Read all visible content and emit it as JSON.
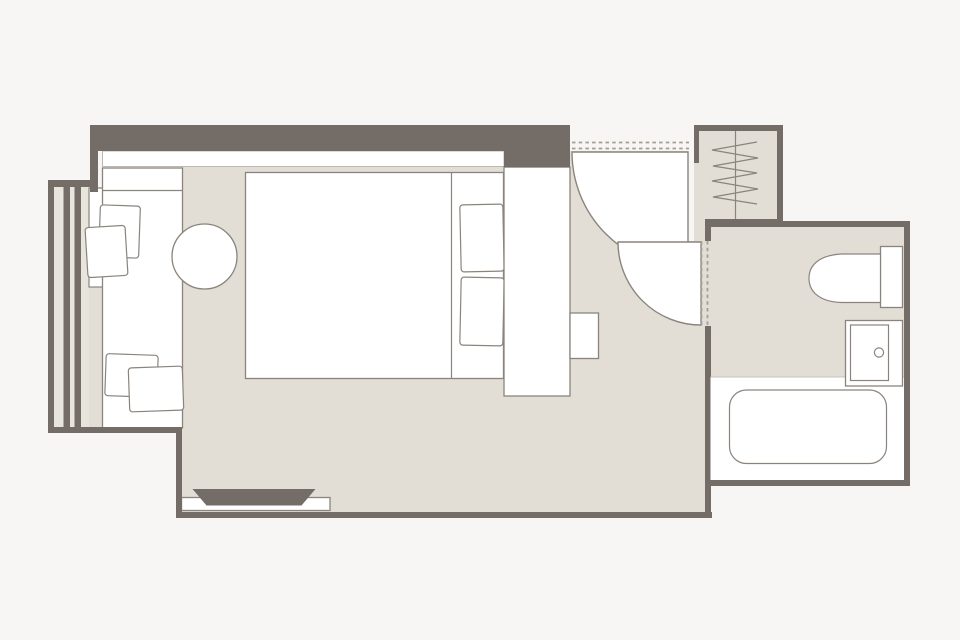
{
  "image": {
    "type": "hotel-room-floor-plan",
    "width_px": 960,
    "height_px": 640
  },
  "colors": {
    "bg": "#f7f6f5",
    "floor": "#e2ded5",
    "wall": "#746d67",
    "white": "#ffffff",
    "line": "#8a847d",
    "lightline": "#bcb7af",
    "dash": "#a49e95",
    "louver": "#e8e5dc"
  },
  "rooms": [
    "bedroom",
    "balcony-lounge",
    "entry",
    "closet",
    "bathroom"
  ],
  "fixtures": [
    "window-louvers",
    "lounge-daybed",
    "lounge-cushions",
    "coffee-table",
    "double-bed",
    "bed-pillows",
    "wardrobe",
    "nightstand",
    "tv-console",
    "tv",
    "entry-door-swing",
    "bathroom-door-swing",
    "closet-hanger-rail",
    "clothes-hangers",
    "toilet",
    "washbasin",
    "bathtub"
  ]
}
